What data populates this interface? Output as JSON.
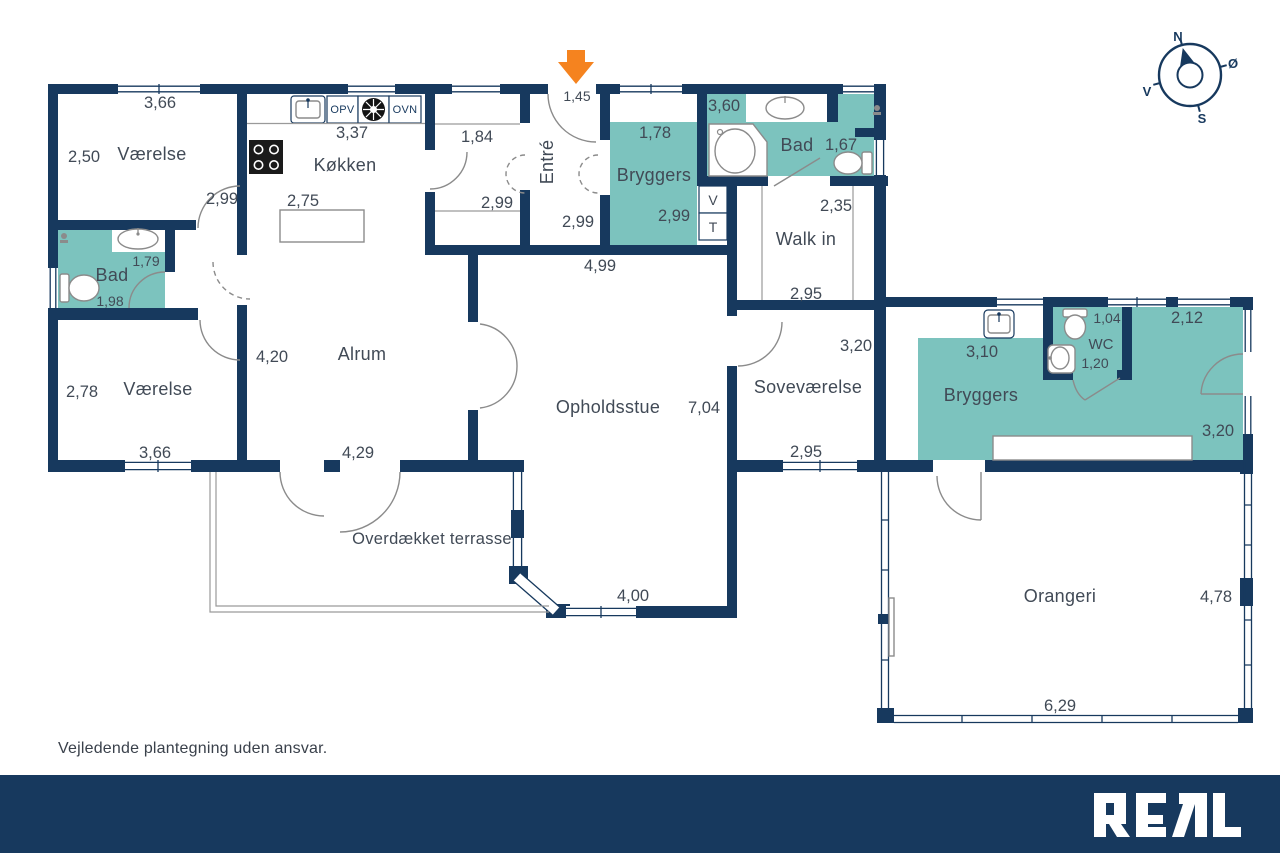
{
  "rooms": {
    "vaerelse_nw": {
      "label": "Værelse",
      "dims": [
        "3,66",
        "2,50",
        "2,99"
      ]
    },
    "koekken": {
      "label": "Køkken",
      "dims": [
        "3,37",
        "2,75"
      ]
    },
    "gang": {
      "dims": [
        "1,84",
        "2,99"
      ]
    },
    "entre": {
      "label": "Entré",
      "dims": [
        "1,45",
        "2,99"
      ]
    },
    "bryggers_nord": {
      "label": "Bryggers",
      "dims": [
        "1,78",
        "2,99"
      ]
    },
    "bad_nord": {
      "label": "Bad",
      "dims": [
        "3,60",
        "1,67"
      ]
    },
    "walk_in": {
      "label": "Walk in",
      "dims": [
        "2,35",
        "2,95"
      ]
    },
    "fordeling": {
      "dims": [
        "4,99"
      ]
    },
    "bad_vest": {
      "label": "Bad",
      "dims": [
        "1,79",
        "1,98"
      ]
    },
    "vaerelse_sv": {
      "label": "Værelse",
      "dims": [
        "2,78",
        "3,66"
      ]
    },
    "alrum": {
      "label": "Alrum",
      "dims": [
        "4,20",
        "4,29"
      ]
    },
    "opholdsstue": {
      "label": "Opholdsstue",
      "dims": [
        "7,04",
        "4,00"
      ]
    },
    "sovevaerelse": {
      "label": "Soveværelse",
      "dims": [
        "3,20",
        "2,95"
      ]
    },
    "bryggers_oest": {
      "label": "Bryggers",
      "dims": [
        "3,10",
        "2,12",
        "3,20"
      ]
    },
    "wc": {
      "label": "WC",
      "dims": [
        "1,04",
        "1,20"
      ]
    },
    "orangeri": {
      "label": "Orangeri",
      "dims": [
        "4,78",
        "6,29"
      ]
    },
    "terrasse": {
      "label": "Overdækket terrasse"
    }
  },
  "appliances": {
    "opv": "OPV",
    "ovn": "OVN",
    "vaskemaskine": "V",
    "toerretumbler": "T"
  },
  "compass": {
    "north": "N",
    "east": "Ø",
    "south": "S",
    "west": "V"
  },
  "footer": {
    "disclaimer": "Vejledende plantegning uden ansvar.",
    "brand": "REAL"
  },
  "colors": {
    "wall": "#17395E",
    "wet_room": "#7CC3BE",
    "entry_arrow": "#F5831F",
    "label_text": "#414A56"
  }
}
